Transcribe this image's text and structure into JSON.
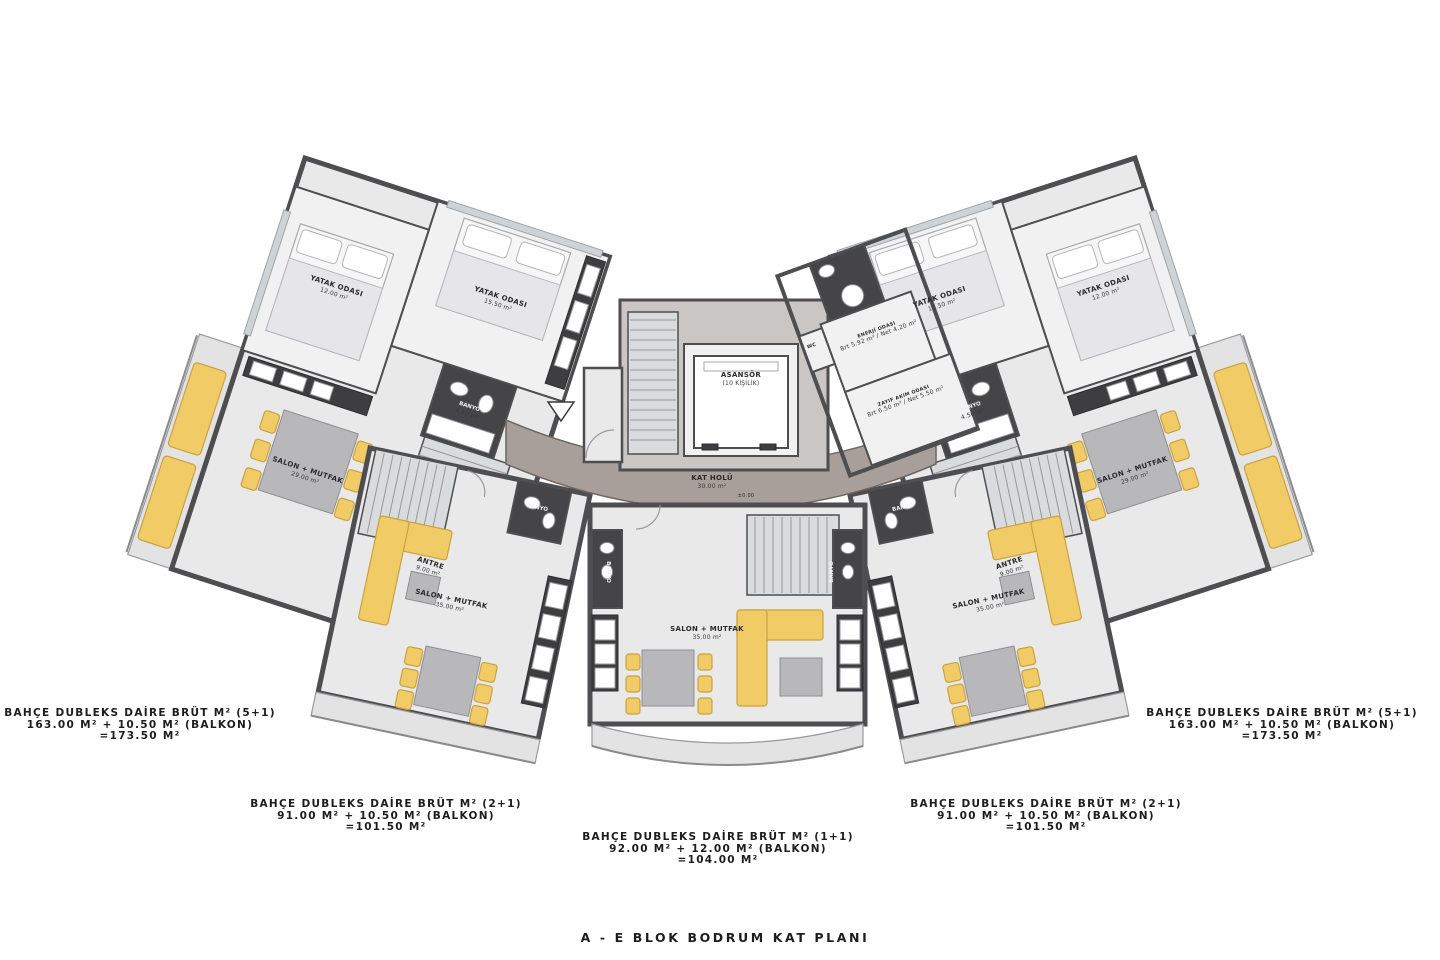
{
  "title": "A - E BLOK BODRUM KAT PLANI",
  "entrance": {
    "label": "BİNA GİRİŞİ"
  },
  "level_marker": "±0.00",
  "colors": {
    "wall": "#4e4e50",
    "floor": "#e9e9ea",
    "floor_light": "#f1f1f2",
    "dark_room": "#454547",
    "corridor": "#a89f9a",
    "core_floor": "#c9c6c3",
    "stair": "#dadbdc",
    "yellow": "#f0cb66",
    "yellow_dark": "#c9a242",
    "furn_gray": "#b8b8ba",
    "balcony": "#e3e3e4",
    "window": "#ced3d5",
    "text": "#1d1d1f"
  },
  "rooms": {
    "asansor": {
      "name": "ASANSÖR",
      "detail": "(10 KİŞİLİK)"
    },
    "kat_holu": {
      "name": "KAT HOLÜ",
      "area": "30.00 m²"
    },
    "yatak_15": {
      "name": "YATAK ODASI",
      "area": "15.50 m²"
    },
    "yatak_12": {
      "name": "YATAK ODASI",
      "area": "12.00 m²"
    },
    "salon_29": {
      "name": "SALON + MUTFAK",
      "area": "29.00 m²"
    },
    "salon_35": {
      "name": "SALON + MUTFAK",
      "area": "35.00 m²"
    },
    "antre_9": {
      "name": "ANTRE",
      "area": "9.00 m²"
    },
    "banyo_45": {
      "name": "BANYO",
      "area": "4.50 m²"
    },
    "banyo": {
      "name": "BANYO"
    },
    "wc": {
      "name": "WC"
    },
    "enerji": {
      "name": "ENERJİ ODASI",
      "detail": "Brt 5.92 m² / Net 4.20 m²"
    },
    "zayif": {
      "name": "ZAYIF AKIM ODASI",
      "detail": "Brt 6.50 m² / Net 5.50 m²"
    }
  },
  "unit_labels": [
    {
      "id": "left-5plus1",
      "line1": "BAHÇE DUBLEKS DAİRE BRÜT M² (5+1)",
      "line2": "163.00 M² + 10.50 M² (BALKON)",
      "line3": "=173.50 M²"
    },
    {
      "id": "left-2plus1",
      "line1": "BAHÇE DUBLEKS DAİRE BRÜT M² (2+1)",
      "line2": "91.00 M² + 10.50 M² (BALKON)",
      "line3": "=101.50 M²"
    },
    {
      "id": "center-1plus1",
      "line1": "BAHÇE DUBLEKS DAİRE BRÜT M² (1+1)",
      "line2": "92.00 M² + 12.00 M² (BALKON)",
      "line3": "=104.00 M²"
    },
    {
      "id": "right-2plus1",
      "line1": "BAHÇE DUBLEKS DAİRE BRÜT M² (2+1)",
      "line2": "91.00 M² + 10.50 M² (BALKON)",
      "line3": "=101.50 M²"
    },
    {
      "id": "right-5plus1",
      "line1": "BAHÇE DUBLEKS DAİRE BRÜT M² (5+1)",
      "line2": "163.00 M² + 10.50 M² (BALKON)",
      "line3": "=173.50 M²"
    }
  ]
}
